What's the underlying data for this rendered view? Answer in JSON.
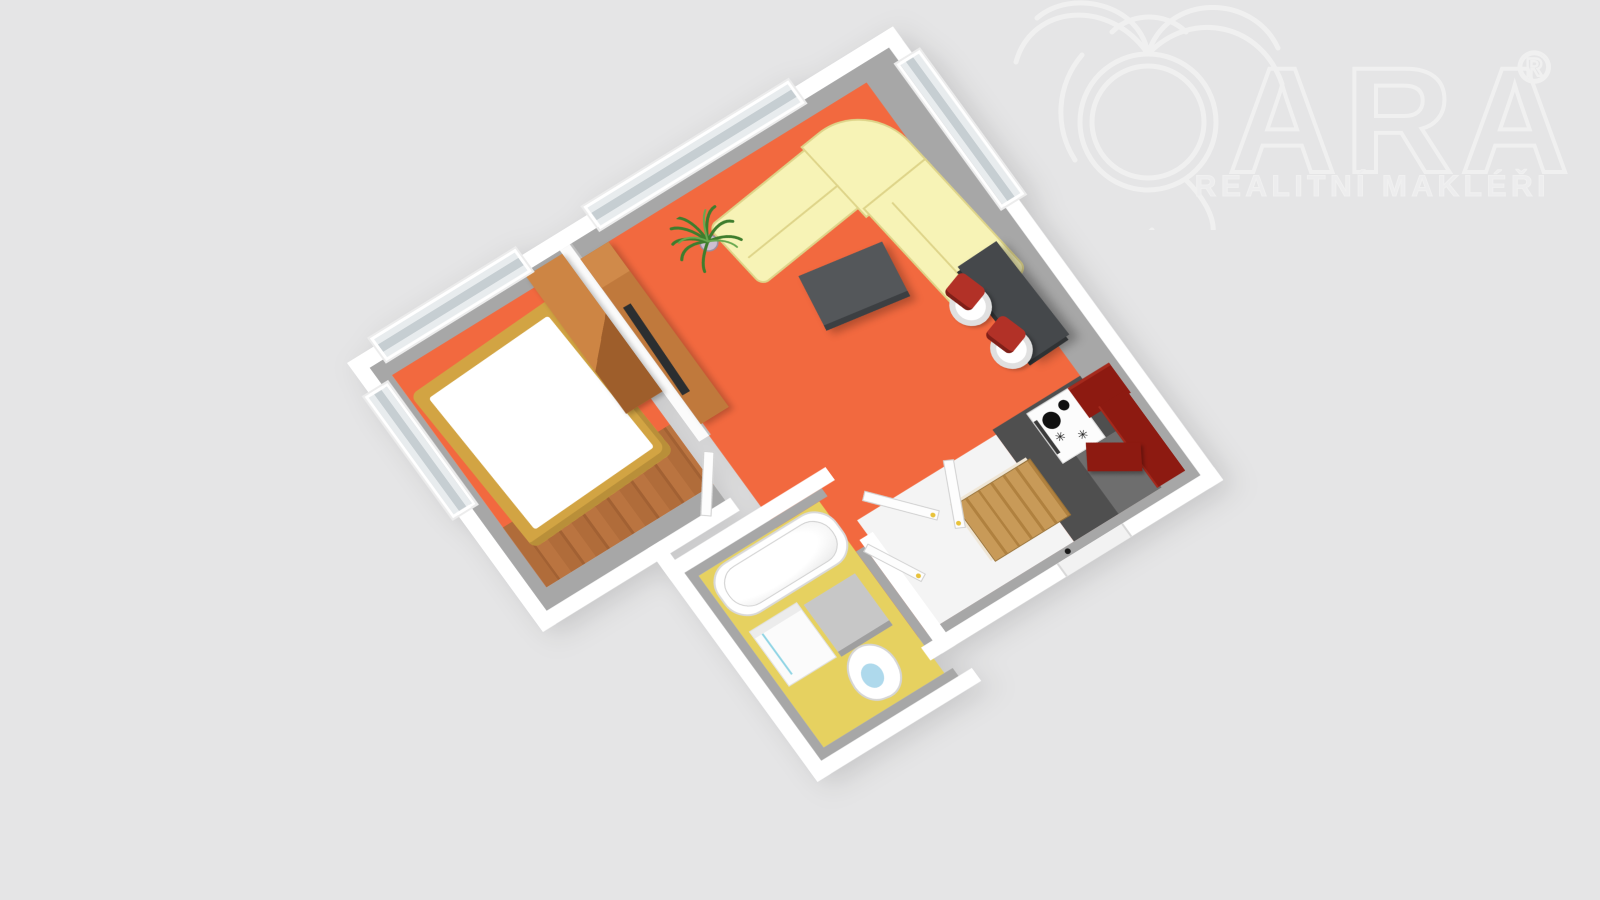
{
  "logo": {
    "brand": "QARA",
    "brand_display": "ARA",
    "registered": "®",
    "subtitle": "REALITNÍ MAKLÉŘI",
    "icon": "palm-q-icon"
  },
  "scene": {
    "type": "3d-floor-plan-render",
    "rooms": [
      {
        "name": "bedroom",
        "floor_color": "#f2693f",
        "furniture": [
          "double-bed",
          "wardrobe",
          "wood-floor-strip",
          "window"
        ]
      },
      {
        "name": "living-room",
        "floor_color": "#f2693f",
        "furniture": [
          "corner-sofa",
          "coffee-table",
          "potted-plant",
          "tv-stand",
          "tv",
          "bar-table",
          "bar-stool",
          "bar-stool"
        ]
      },
      {
        "name": "kitchen",
        "floor_color": "#4f4f4f",
        "furniture": [
          "stove",
          "red-cabinets"
        ]
      },
      {
        "name": "bathroom",
        "floor_color": "#e6d160",
        "furniture": [
          "bathtub",
          "washing-machine",
          "cabinet",
          "toilet"
        ]
      },
      {
        "name": "hall",
        "floor_color": "#f4f4f4",
        "furniture": [
          "oak-cabinet",
          "entry-door"
        ]
      }
    ]
  },
  "colors": {
    "background": "#e5e5e6",
    "wall_white": "#ffffff",
    "wall_face_gray": "#a7a7a7",
    "floor_orange": "#f2693f",
    "floor_bath_yellow": "#e6d160",
    "floor_kitchen_dark": "#4f4f4f",
    "floor_kitchen_light": "#6e6e6e",
    "floor_hall_white": "#f4f4f4",
    "wood_strip": "#b06c3a",
    "sofa_yellow": "#f7f3b6",
    "sofa_edge": "#ded489",
    "bed_frame_gold": "#d2a443",
    "wardrobe_brown": "#c0793c",
    "tv_black": "#2b2e30",
    "cabinet_red": "#8d1a11",
    "stool_red": "#b23127",
    "table_dark": "#54575a",
    "bar_dark": "#45484b",
    "oak_cabinet": "#c89a58",
    "plant_green": "#3e7d2d",
    "logo_stroke": "#f0f0f0"
  }
}
